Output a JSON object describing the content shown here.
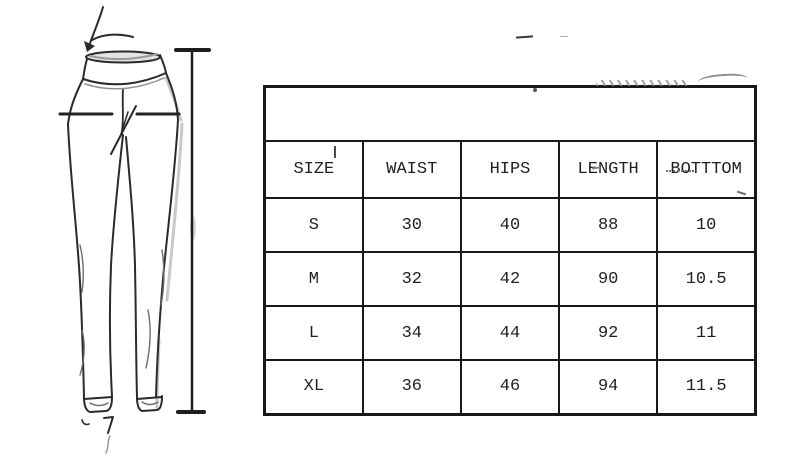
{
  "page": {
    "background_color": "#ffffff",
    "ink_color": "#1f1f1f"
  },
  "pants_diagram": {
    "description": "Hand-drawn front view of high-waist skinny pants (leggings) with measurement guide marks",
    "annotations": [
      {
        "icon": "waist-arrow-icon",
        "meaning": "waist position"
      },
      {
        "icon": "hips-line-icon",
        "meaning": "hips position"
      },
      {
        "icon": "length-line-icon",
        "meaning": "full length"
      },
      {
        "icon": "bottom-mark-icon",
        "meaning": "leg opening (bottom)"
      }
    ]
  },
  "size_chart": {
    "columns": [
      "SIZE",
      "WAIST",
      "HIPS",
      "LENGTH",
      "BOTTTOM"
    ],
    "rows": [
      [
        "S",
        "30",
        "40",
        "88",
        "10"
      ],
      [
        "M",
        "32",
        "42",
        "90",
        "10.5"
      ],
      [
        "L",
        "34",
        "44",
        "92",
        "11"
      ],
      [
        "XL",
        "36",
        "46",
        "94",
        "11.5"
      ]
    ]
  },
  "chart_data": {
    "type": "table",
    "columns": [
      "SIZE",
      "WAIST",
      "HIPS",
      "LENGTH",
      "BOTTTOM"
    ],
    "rows": [
      [
        "S",
        30,
        40,
        88,
        10
      ],
      [
        "M",
        32,
        42,
        90,
        10.5
      ],
      [
        "L",
        34,
        44,
        92,
        11
      ],
      [
        "XL",
        36,
        46,
        94,
        11.5
      ]
    ]
  }
}
